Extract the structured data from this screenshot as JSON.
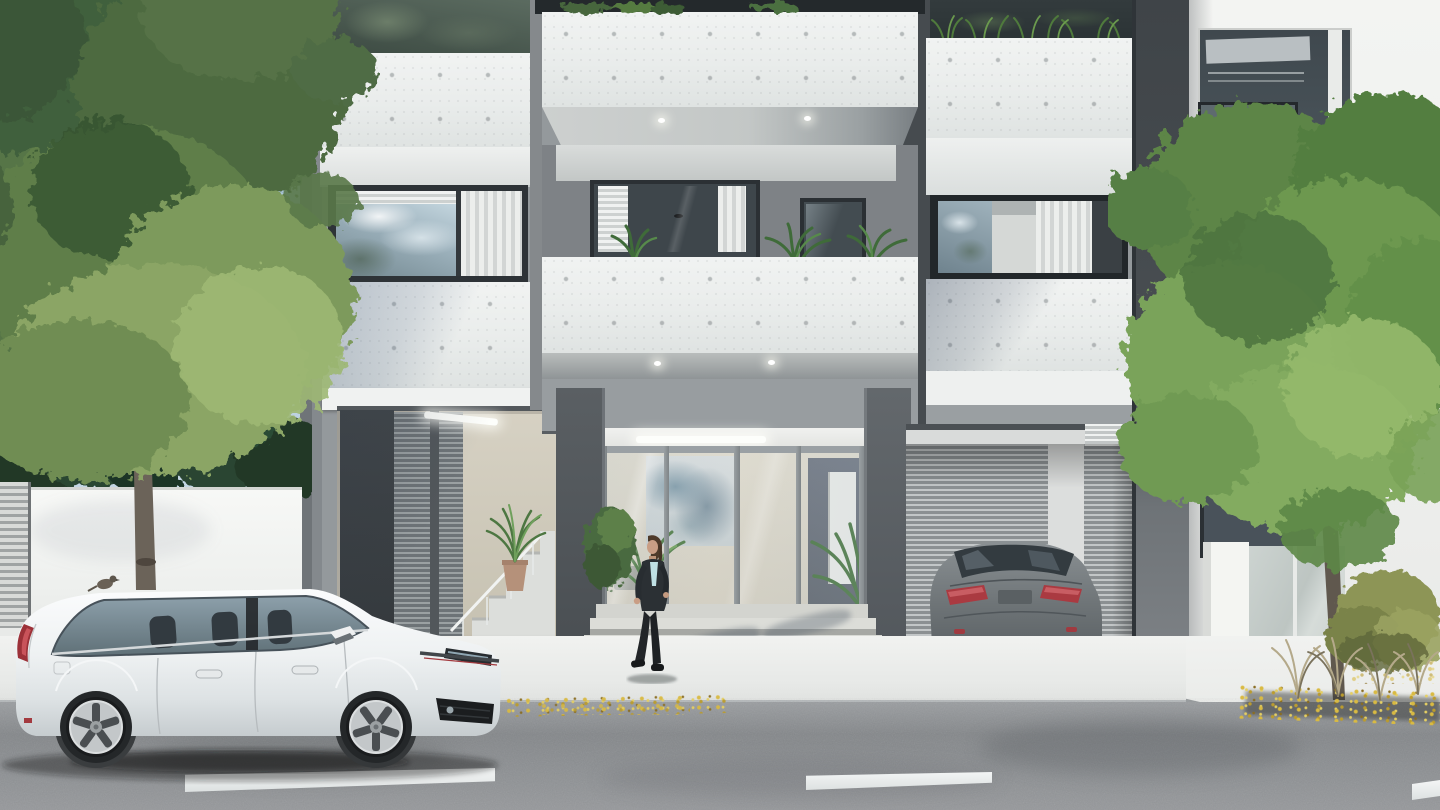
{
  "scene": {
    "title": "Street-level architectural rendering of a modern apartment building with glazed entrance lobby, parked cars, pedestrians and trees",
    "time_of_day": "daytime, clear sky",
    "palette": {
      "sky": "#a9c3d8",
      "facade_gray": "#94999c",
      "frame_dark": "#33383c",
      "concrete_white": "#eceeed",
      "foliage_green": "#6d9850",
      "conifer_green": "#26402c",
      "road_asphalt": "#85888a",
      "sidewalk_white": "#f0f1ef",
      "taillight_red": "#a83239",
      "autumn_leaf_yellow": "#d4b344",
      "car_white": "#f2f5f6",
      "car_gray": "#6e7477",
      "interior_beige": "#d8d4c7"
    },
    "objects": {
      "building": {
        "label": "three-storey concrete and glass apartment facade with white board-formed balcony parapets"
      },
      "entrance": {
        "label": "glazed double-height entrance lobby with abstract wall art and concrete steps"
      },
      "left_stair_bay": {
        "label": "side bay with louvred screens, stair and potted plant"
      },
      "garage": {
        "label": "driveway bay with louvred back wall"
      },
      "neighbour_building": {
        "label": "adjacent white building with dark window openings"
      },
      "left_tree": {
        "label": "large deciduous tree over white boundary wall"
      },
      "right_tree": {
        "label": "street tree in front of neighbouring building"
      },
      "conifers": {
        "label": "dark conifer hedge behind boundary wall"
      },
      "white_car": {
        "label": "white five-door hatchback parked at the kerb"
      },
      "gray_car": {
        "label": "gray sedan parked in the driveway"
      },
      "woman": {
        "label": "woman in dark suit walking past the entrance steps"
      },
      "man": {
        "label": "man in suit talking on phone inside the lobby"
      },
      "bird": {
        "label": "small bird perched on the car roof"
      },
      "lane_markings": {
        "label": "white broken lane line on asphalt"
      },
      "autumn_leaves": {
        "label": "yellow leaves drifted along the kerb"
      },
      "grasses": {
        "label": "dry ornamental grasses and shrub on right sidewalk"
      }
    }
  }
}
